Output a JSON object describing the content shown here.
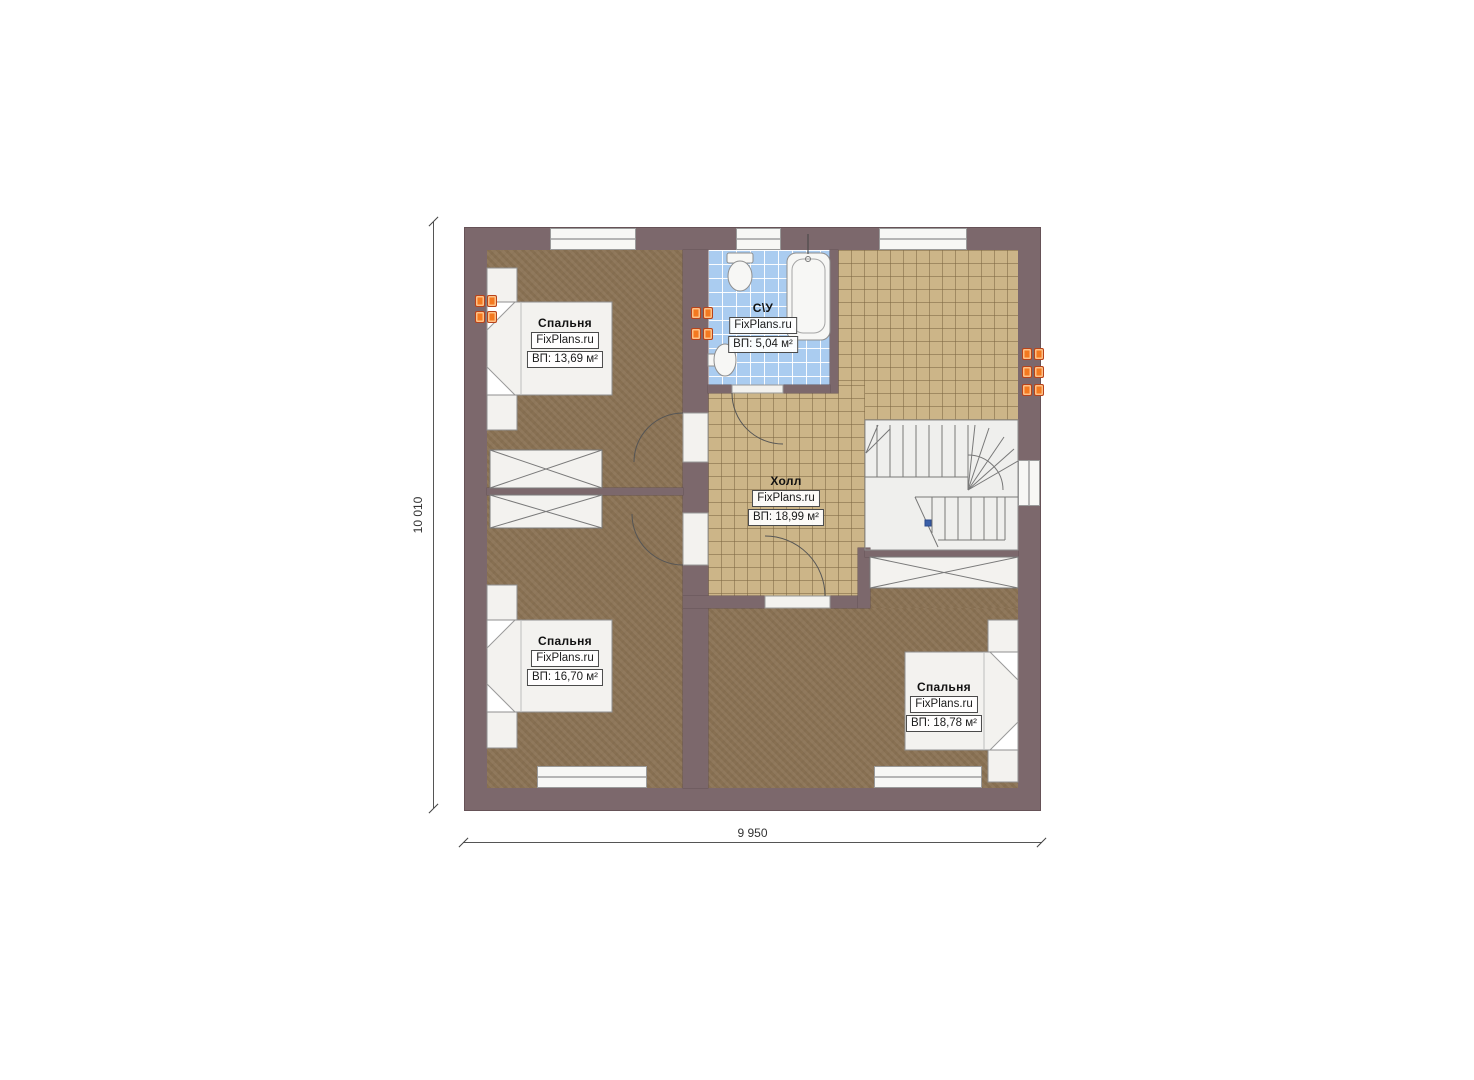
{
  "plan": {
    "rooms": {
      "bedroom_top_left": {
        "name": "Спальня",
        "brand": "FixPlans.ru",
        "area": "ВП: 13,69 м²"
      },
      "bedroom_bottom_left": {
        "name": "Спальня",
        "brand": "FixPlans.ru",
        "area": "ВП: 16,70 м²"
      },
      "bedroom_bottom_right": {
        "name": "Спальня",
        "brand": "FixPlans.ru",
        "area": "ВП: 18,78 м²"
      },
      "bathroom": {
        "name": "С\\У",
        "brand": "FixPlans.ru",
        "area": "ВП: 5,04 м²"
      },
      "hall": {
        "name": "Холл",
        "brand": "FixPlans.ru",
        "area": "ВП: 18,99 м²"
      }
    },
    "dimensions": {
      "horizontal": "9 950",
      "vertical": "10 010"
    },
    "colors": {
      "wall": "#7c686c",
      "floor_wood": "#8c7456",
      "floor_tile_tan": "#ccb588",
      "floor_tile_blue": "#aaccf0",
      "furniture": "#f3f2ef",
      "radiator": "#f4791f",
      "stair_marker": "#3a5fa8"
    }
  }
}
